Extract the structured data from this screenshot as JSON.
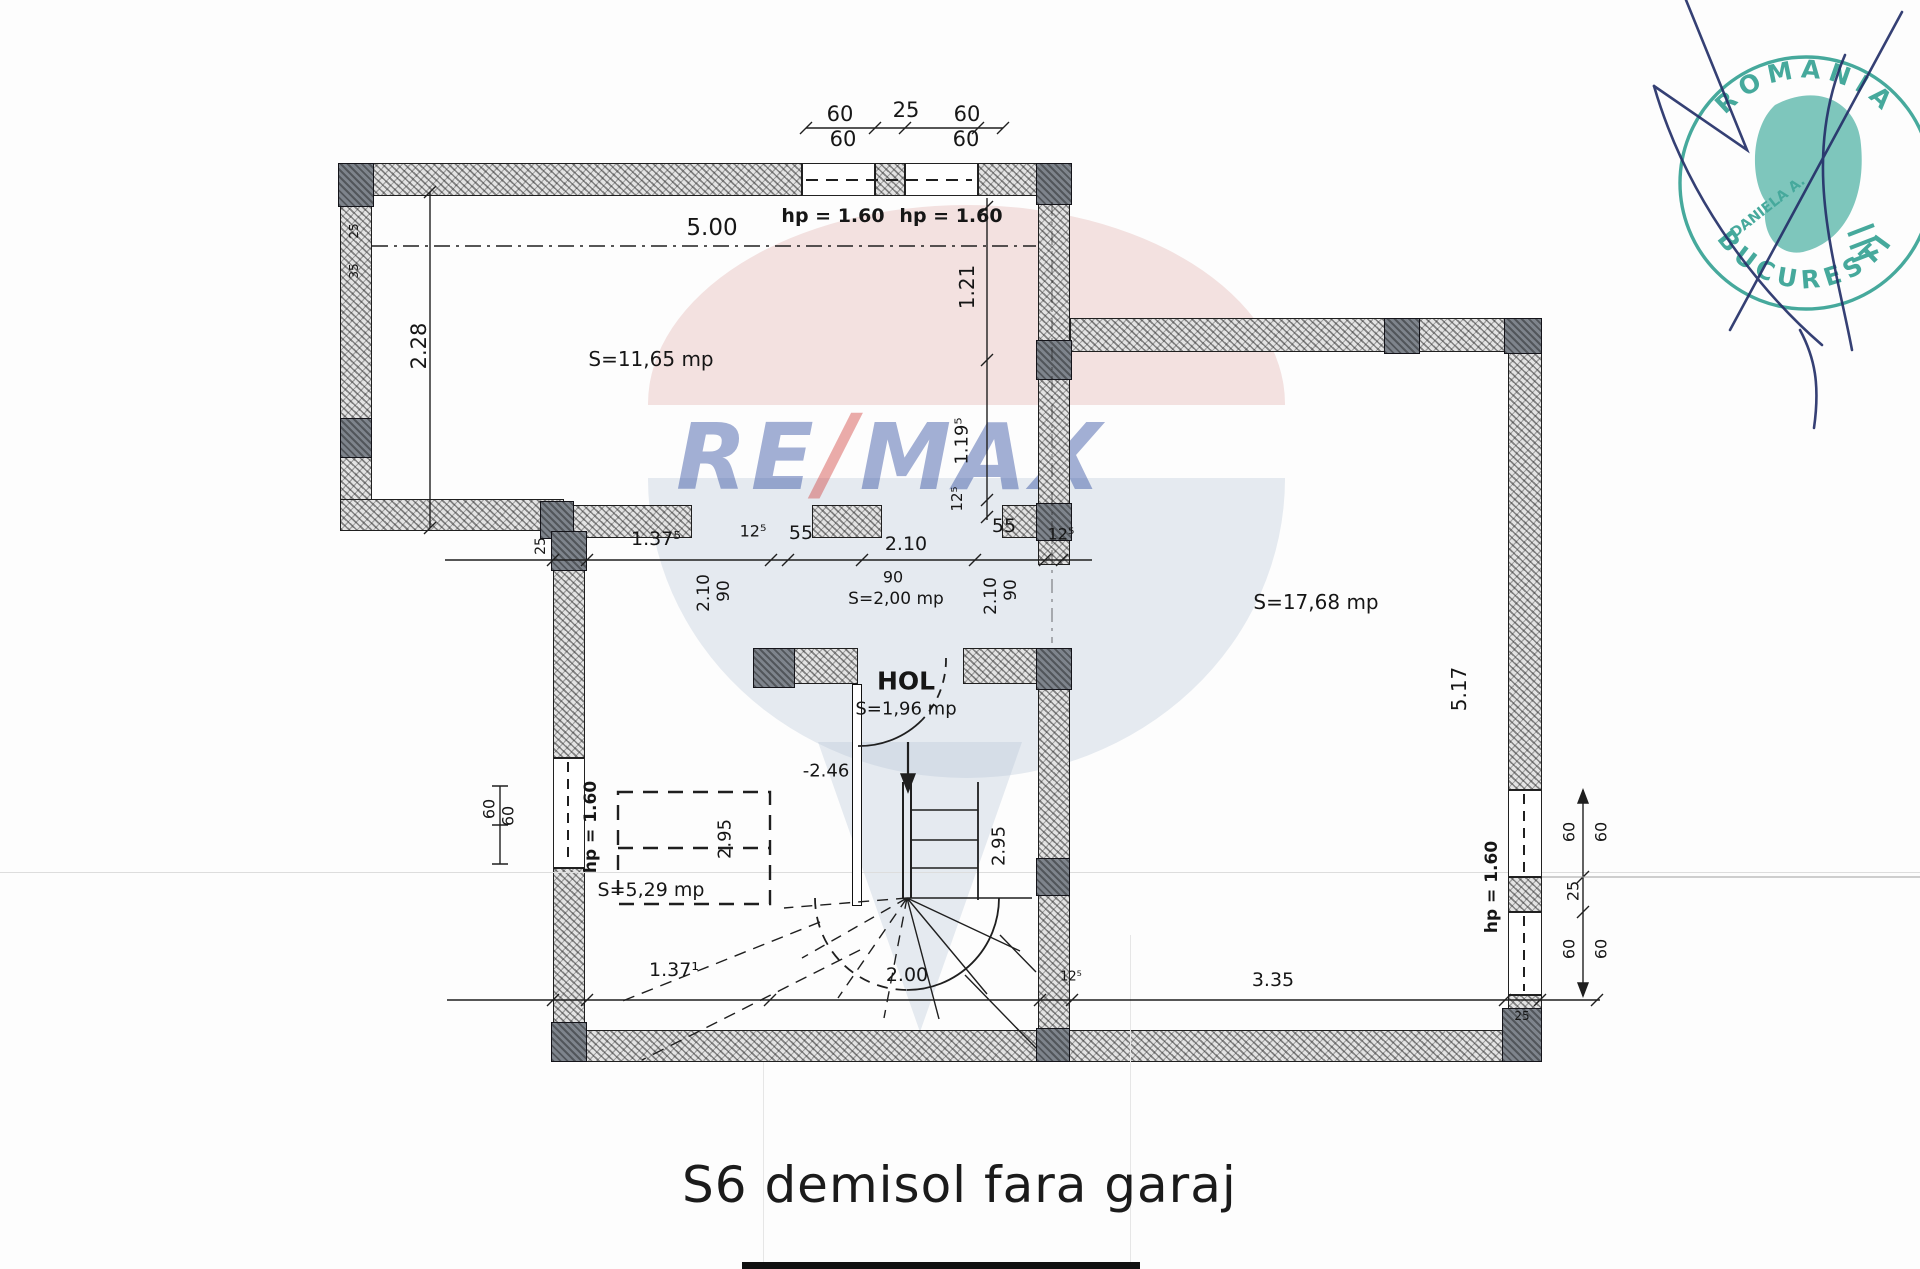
{
  "caption": "S6 demisol fara garaj",
  "watermark": {
    "part1": "RE",
    "slash": "/",
    "part2": "MAX",
    "blue": "#27459c",
    "red": "#d03c38"
  },
  "stamp": {
    "arc_top": "ROMANIA",
    "arc_bottom": "BUCURESTI",
    "center": "DANIELA A.",
    "color": "#279b8c"
  },
  "plan": {
    "level_marker": "-2.46",
    "room_areas": [
      "S=11,65 mp",
      "S=17,68 mp",
      "S=5,29 mp",
      "S=2,00 mp",
      "S=1,96 mp"
    ],
    "hall_name": "HOL",
    "labels": [
      {
        "t": "60",
        "x": 840,
        "y": 114,
        "s": 21
      },
      {
        "t": "25",
        "x": 906,
        "y": 110,
        "s": 21
      },
      {
        "t": "60",
        "x": 967,
        "y": 114,
        "s": 21
      },
      {
        "t": "60",
        "x": 843,
        "y": 139,
        "s": 21
      },
      {
        "t": "60",
        "x": 966,
        "y": 139,
        "s": 21
      },
      {
        "t": "5.00",
        "x": 712,
        "y": 228,
        "s": 23
      },
      {
        "t": "hp = 1.60",
        "x": 833,
        "y": 216,
        "s": 19,
        "w": 700
      },
      {
        "t": "hp = 1.60",
        "x": 951,
        "y": 216,
        "s": 19,
        "w": 700
      },
      {
        "t": "1.21",
        "x": 967,
        "y": 287,
        "r": -90,
        "s": 20
      },
      {
        "t": "1.19⁵",
        "x": 962,
        "y": 441,
        "r": -90,
        "s": 18
      },
      {
        "t": "12⁵",
        "x": 957,
        "y": 499,
        "r": -90,
        "s": 15
      },
      {
        "t": "S=11,65 mp",
        "x": 651,
        "y": 359,
        "s": 20,
        "n": "room-label-s1165"
      },
      {
        "t": "2.28",
        "x": 419,
        "y": 346,
        "r": -90,
        "s": 21
      },
      {
        "t": "25",
        "x": 354,
        "y": 231,
        "r": -90,
        "s": 12
      },
      {
        "t": "35",
        "x": 354,
        "y": 271,
        "r": -90,
        "s": 12
      },
      {
        "t": "25",
        "x": 541,
        "y": 546,
        "r": -90,
        "s": 14
      },
      {
        "t": "1.37⁵",
        "x": 656,
        "y": 539,
        "s": 19
      },
      {
        "t": "12⁵",
        "x": 753,
        "y": 531,
        "s": 16
      },
      {
        "t": "55",
        "x": 801,
        "y": 533,
        "s": 19
      },
      {
        "t": "2.10",
        "x": 906,
        "y": 544,
        "s": 19
      },
      {
        "t": "55",
        "x": 1004,
        "y": 526,
        "s": 19
      },
      {
        "t": "12⁵",
        "x": 1061,
        "y": 534,
        "s": 16
      },
      {
        "t": "2.10",
        "x": 704,
        "y": 593,
        "r": -90,
        "s": 17
      },
      {
        "t": "90",
        "x": 724,
        "y": 591,
        "r": -90,
        "s": 17
      },
      {
        "t": "90",
        "x": 893,
        "y": 577,
        "s": 16
      },
      {
        "t": "S=2,00 mp",
        "x": 896,
        "y": 599,
        "s": 17,
        "n": "room-label-s200"
      },
      {
        "t": "2.10",
        "x": 991,
        "y": 596,
        "r": -90,
        "s": 17
      },
      {
        "t": "90",
        "x": 1011,
        "y": 590,
        "r": -90,
        "s": 17
      },
      {
        "t": "S=17,68 mp",
        "x": 1316,
        "y": 602,
        "s": 20,
        "n": "room-label-s1768"
      },
      {
        "t": "5.17",
        "x": 1459,
        "y": 689,
        "r": -90,
        "s": 20
      },
      {
        "t": "HOL",
        "x": 906,
        "y": 681,
        "s": 25,
        "w": 700,
        "n": "room-label-hol"
      },
      {
        "t": "S=1,96 mp",
        "x": 906,
        "y": 709,
        "s": 18,
        "n": "room-label-s196"
      },
      {
        "t": "-2.46",
        "x": 826,
        "y": 771,
        "s": 18,
        "n": "level-marker"
      },
      {
        "t": "60",
        "x": 489,
        "y": 809,
        "r": -90,
        "s": 16
      },
      {
        "t": "60",
        "x": 508,
        "y": 816,
        "r": -90,
        "s": 16
      },
      {
        "t": "hp = 1.60",
        "x": 591,
        "y": 827,
        "r": -90,
        "s": 17,
        "w": 700
      },
      {
        "t": "S=5,29 mp",
        "x": 651,
        "y": 890,
        "s": 19,
        "n": "room-label-s529"
      },
      {
        "t": "2.95",
        "x": 725,
        "y": 839,
        "r": -90,
        "s": 18
      },
      {
        "t": "2.95",
        "x": 999,
        "y": 846,
        "r": -90,
        "s": 18
      },
      {
        "t": "1.37¹",
        "x": 674,
        "y": 970,
        "s": 19
      },
      {
        "t": "2.00",
        "x": 907,
        "y": 975,
        "s": 19
      },
      {
        "t": "12⁵",
        "x": 1071,
        "y": 977,
        "s": 13
      },
      {
        "t": "3.35",
        "x": 1273,
        "y": 980,
        "s": 19
      },
      {
        "t": "hp = 1.60",
        "x": 1492,
        "y": 887,
        "r": -90,
        "s": 17,
        "w": 700
      },
      {
        "t": "60",
        "x": 1569,
        "y": 832,
        "r": -90,
        "s": 16
      },
      {
        "t": "60",
        "x": 1601,
        "y": 832,
        "r": -90,
        "s": 16
      },
      {
        "t": "25",
        "x": 1573,
        "y": 891,
        "r": -90,
        "s": 16
      },
      {
        "t": "60",
        "x": 1569,
        "y": 949,
        "r": -90,
        "s": 16
      },
      {
        "t": "60",
        "x": 1601,
        "y": 949,
        "r": -90,
        "s": 16
      },
      {
        "t": "25",
        "x": 1522,
        "y": 1016,
        "s": 12
      }
    ]
  }
}
